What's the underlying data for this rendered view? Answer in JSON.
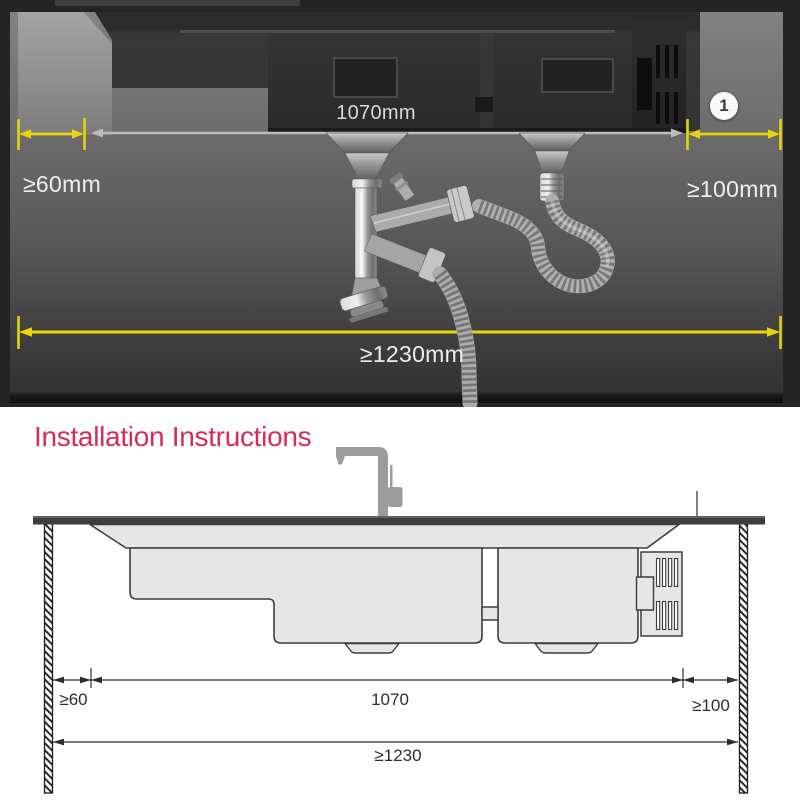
{
  "photo": {
    "dim_top_width": "1070mm",
    "dim_left_clearance": "≥60mm",
    "dim_right_clearance": "≥100mm",
    "dim_total_width": "≥1230mm",
    "badge_number": "1",
    "colors": {
      "dimension_yellow": "#e9d30c",
      "dimension_gray": "#bcbcbc",
      "label_white": "#efefef"
    }
  },
  "instructions": {
    "title": "Installation Instructions",
    "title_color": "#da2a5c",
    "dim_left_clearance": "≥60",
    "dim_basin_width": "1070",
    "dim_right_clearance": "≥100",
    "dim_total_width": "≥1230"
  }
}
